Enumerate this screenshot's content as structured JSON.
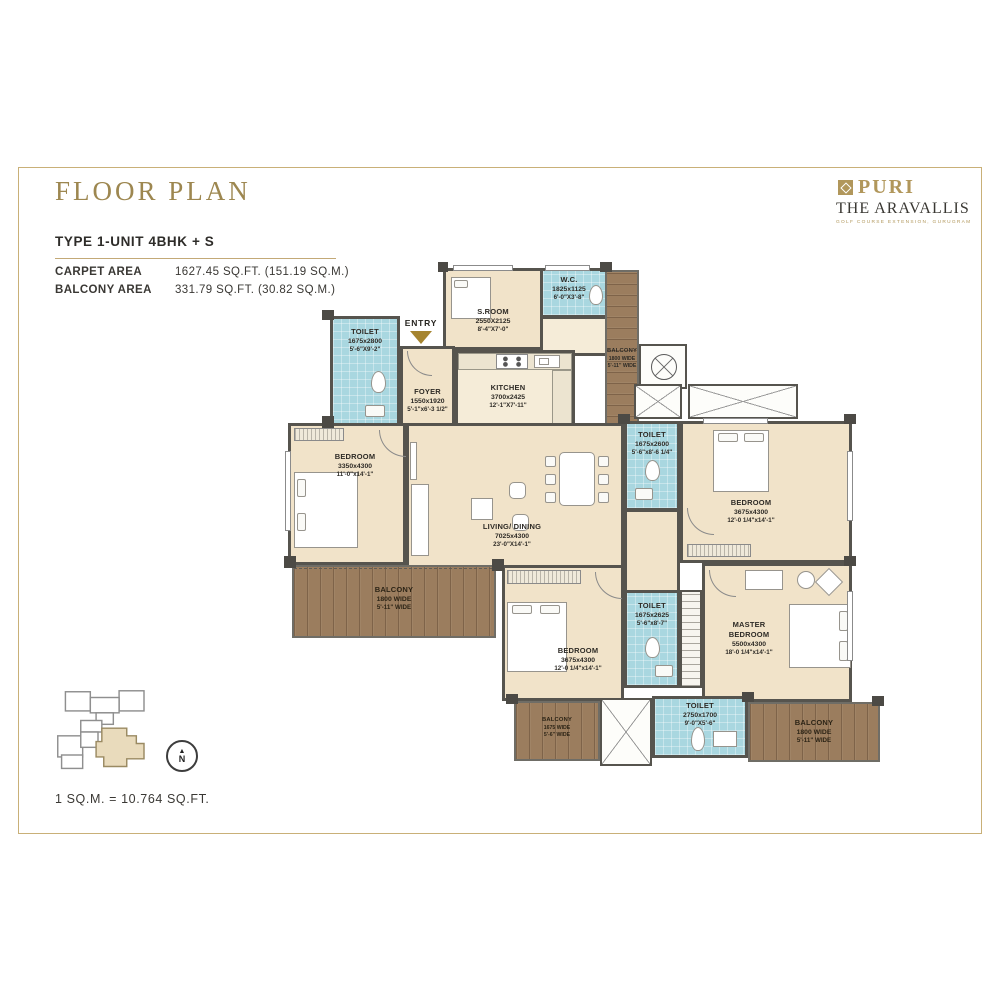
{
  "page": {
    "title": "FLOOR PLAN",
    "scale_note": "1 SQ.M. = 10.764 SQ.FT."
  },
  "brand": {
    "name": "PURI",
    "project": "THE ARAVALLIS",
    "tagline": "GOLF COURSE EXTENSION, GURUGRAM"
  },
  "unit": {
    "type": "TYPE 1-UNIT 4BHK + S",
    "carpet_label": "CARPET AREA",
    "carpet_value": "1627.45 SQ.FT. (151.19 SQ.M.)",
    "balcony_label": "BALCONY AREA",
    "balcony_value": "331.79 SQ.FT. (30.82 SQ.M.)"
  },
  "plan": {
    "entry_label": "ENTRY",
    "north_label": "N",
    "rooms": {
      "s_room": {
        "name": "S.ROOM",
        "dim_mm": "2550X2125",
        "dim_ft": "8'-4\"X7'-0\""
      },
      "wc": {
        "name": "W.C.",
        "dim_mm": "1825x1125",
        "dim_ft": "6'-0\"X3'-8\""
      },
      "toilet_entry": {
        "name": "TOILET",
        "dim_mm": "1675x2800",
        "dim_ft": "5'-6\"X9'-2\""
      },
      "foyer": {
        "name": "FOYER",
        "dim_mm": "1550x1920",
        "dim_ft": "5'-1\"x6'-3 1/2\""
      },
      "kitchen": {
        "name": "KITCHEN",
        "dim_mm": "3700x2425",
        "dim_ft": "12'-1\"X7'-11\""
      },
      "bedroom_left": {
        "name": "BEDROOM",
        "dim_mm": "3350x4300",
        "dim_ft": "11'-0\"x14'-1\""
      },
      "living_dining": {
        "name": "LIVING/ DINING",
        "dim_mm": "7025x4300",
        "dim_ft": "23'-0\"X14'-1\""
      },
      "toilet_right": {
        "name": "TOILET",
        "dim_mm": "1675x2600",
        "dim_ft": "5'-6\"x8'-6 1/4\""
      },
      "bedroom_top_right": {
        "name": "BEDROOM",
        "dim_mm": "3675x4300",
        "dim_ft": "12'-0 1/4\"x14'-1\""
      },
      "master_bedroom": {
        "name": "MASTER BEDROOM",
        "dim_mm": "5500x4300",
        "dim_ft": "18'-0 1/4\"x14'-1\""
      },
      "bedroom_bottom": {
        "name": "BEDROOM",
        "dim_mm": "3675x4300",
        "dim_ft": "12'-0 1/4\"x14'-1\""
      },
      "toilet_mid_bottom": {
        "name": "TOILET",
        "dim_mm": "1675x2625",
        "dim_ft": "5'-6\"x8'-7\""
      },
      "toilet_bottom": {
        "name": "TOILET",
        "dim_mm": "2750x1700",
        "dim_ft": "9'-0\"X5'-6\""
      },
      "balcony_top_right": {
        "name": "BALCONY",
        "dim_mm": "1800 WIDE",
        "dim_ft": "5'-11\" WIDE"
      },
      "balcony_left": {
        "name": "BALCONY",
        "dim_mm": "1800 WIDE",
        "dim_ft": "5'-11\" WIDE"
      },
      "balcony_bottom_left": {
        "name": "BALCONY",
        "dim_mm": "1675 WIDE",
        "dim_ft": "5'-6\" WIDE"
      },
      "balcony_bottom_right": {
        "name": "BALCONY",
        "dim_mm": "1800 WIDE",
        "dim_ft": "5'-11\" WIDE"
      }
    }
  },
  "colors": {
    "gold": "#9d8750",
    "line_gold": "#c3a977",
    "wall": "#56544e",
    "floor_beige": "#f1e3c9",
    "toilet_blue": "#a9d7e0",
    "balcony_wood": "#9b7d5e",
    "entry_arrow": "#a5842f"
  }
}
